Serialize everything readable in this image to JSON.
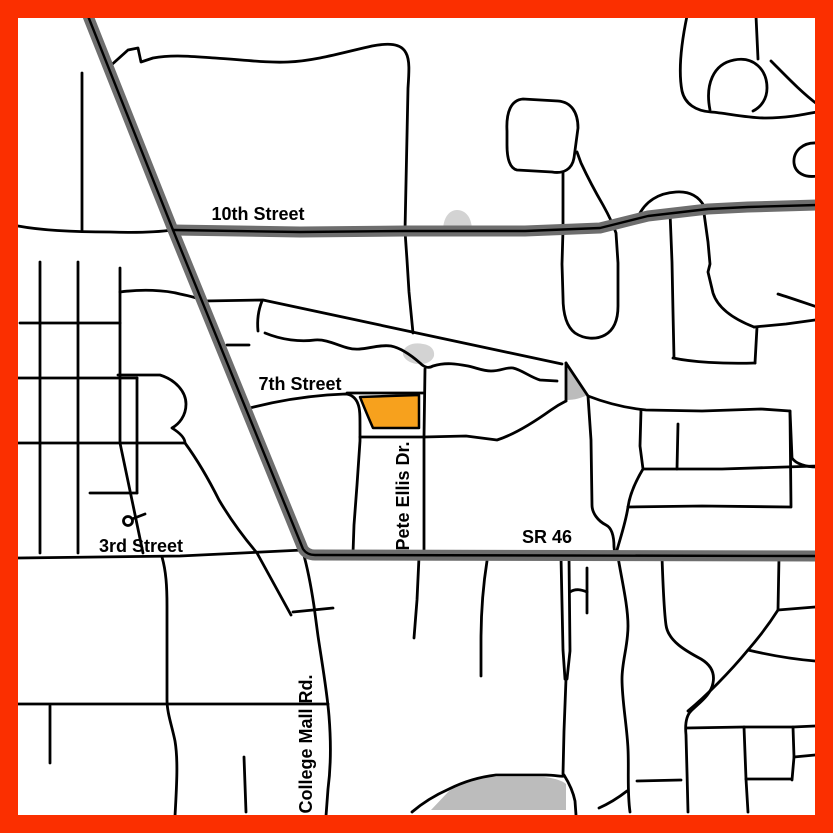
{
  "map": {
    "type": "street-map",
    "labels": {
      "street_10th": "10th Street",
      "street_7th": "7th Street",
      "pete_ellis": "Pete Ellis Dr.",
      "sr_46": "SR 46",
      "street_3rd": "3rd Street",
      "college_mall": "College Mall Rd."
    },
    "colors": {
      "border": "#FB2F00",
      "background": "#FFFFFF",
      "major_road": "#6E6E6E",
      "minor_road": "#000000",
      "road_centerline": "#000000",
      "highlight_parcel": "#F7A11D",
      "pond": "#D3D3D3",
      "area": "#BCBCBC",
      "label_text": "#000000"
    }
  }
}
